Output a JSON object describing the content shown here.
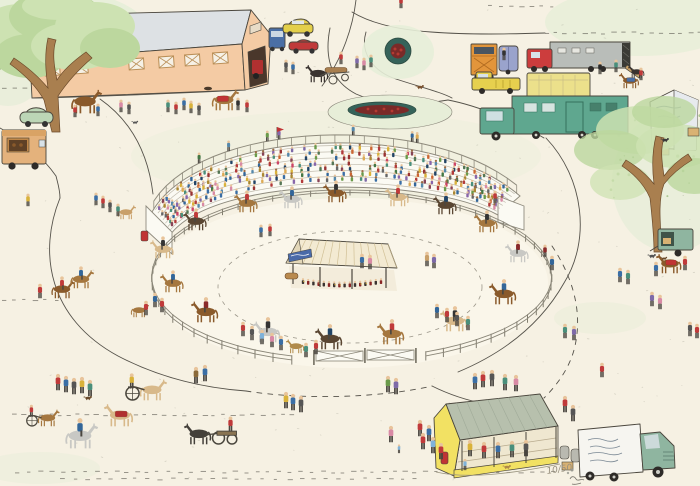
{
  "artwork": {
    "type": "hand-drawn pen and watercolor illustration",
    "subject": "aerial view of a country horse show with oval show ring, grandstand crowd, bandstand, horse lorries, stables and carriages",
    "edition_number": "10/50",
    "signature": "illegible artist signature in pencil",
    "lettering": {
      "prize_tent": "illegible faint hand lettering",
      "delivery_van": "illegible cursive hand lettering"
    }
  },
  "palette": {
    "paper": "#f6f1e3",
    "ringfloor": "#faf6ea",
    "wash": "#e7eed8",
    "ink": "#4a463d",
    "fence": "#85816f",
    "standwhite": "#fbfaf3",
    "barnwall": "#f4cba4",
    "barnroof": "#dde1e4",
    "trunk": "#a97f4f",
    "foliage": "#cde2b2",
    "foliage2": "#bcd79e",
    "caryellow": "#e3cf4a",
    "carblue": "#4a6fa5",
    "carred": "#c03a3a",
    "cargreen": "#bcd6b6",
    "boxtan": "#e4b27c",
    "truckorange": "#e2953b",
    "trailerlav": "#9aa3cc",
    "cabred": "#cc3d3d",
    "trailergray": "#b9bdb9",
    "pickupyellow": "#e6d04e",
    "boxcream": "#ece08b",
    "lorrygreen": "#5fa78f",
    "tentwhite": "#f3f3ef",
    "stallyellow": "#f2e163",
    "stallroof": "#b7c0ad",
    "vangreen": "#8fb5a0",
    "vanwhite": "#f6f5f0",
    "flowerred": "#b53a32",
    "bedgreen": "#35635a",
    "skin": "#e8c49b",
    "pants": "#4a4640"
  },
  "scene": {
    "speckles": 170,
    "dash_rows": [
      {
        "y": 472,
        "x1": 15,
        "x2": 555,
        "step": 9
      },
      {
        "y": 479,
        "x1": 60,
        "x2": 420,
        "step": 11
      },
      {
        "y": 415,
        "x1": 12,
        "x2": 296,
        "step": 8
      },
      {
        "y": 300,
        "x1": 2,
        "x2": 56,
        "step": 9
      },
      {
        "y": 88,
        "x1": 2,
        "x2": 28,
        "step": 8
      },
      {
        "y": 33,
        "x1": 545,
        "x2": 698,
        "step": 8
      },
      {
        "y": 6,
        "x1": 488,
        "x2": 560,
        "step": 9
      }
    ],
    "fence": {
      "cx": 350,
      "cy": 282,
      "rx": 200,
      "ry": 86,
      "posts": 64,
      "gate_deg": [
        72,
        104
      ]
    },
    "crowd": {
      "rows": 7,
      "seats_per_row": 48,
      "skip_rate": 0.18,
      "colors": [
        "#b23a3a",
        "#3a6ea5",
        "#4a8f7b",
        "#d9b23a",
        "#d98aa5",
        "#7e6aa8",
        "#6a9a4a",
        "#cc6633",
        "#447744",
        "#884455",
        "#5588aa",
        "#aa8833",
        "#336699",
        "#993333",
        "#557755",
        "#8866aa",
        "#ddaa55",
        "#cc4466",
        "#666666",
        "#224466"
      ],
      "skin": [
        "#e8c49b",
        "#9c6b44"
      ]
    },
    "people": [
      [
        28,
        206,
        "#d9b23a"
      ],
      [
        40,
        298,
        "#c03a3a"
      ],
      [
        96,
        205,
        "#3a6ea5"
      ],
      [
        103,
        208,
        "#c03a3a"
      ],
      [
        110,
        212,
        "#555555"
      ],
      [
        118,
        216,
        "#4a8f7b"
      ],
      [
        75,
        117,
        "#c03a3a"
      ],
      [
        98,
        116,
        "#3a6ea5"
      ],
      [
        121,
        112,
        "#d98aa5"
      ],
      [
        129,
        114,
        "#555555"
      ],
      [
        168,
        112,
        "#4a8f7b"
      ],
      [
        176,
        114,
        "#c03a3a"
      ],
      [
        184,
        110,
        "#3a6ea5"
      ],
      [
        191,
        113,
        "#d9b23a"
      ],
      [
        199,
        115,
        "#555555"
      ],
      [
        238,
        110,
        "#333333"
      ],
      [
        247,
        112,
        "#c03a3a"
      ],
      [
        286,
        72,
        "#555555"
      ],
      [
        293,
        74,
        "#3a6ea5"
      ],
      [
        341,
        64,
        "#c03a3a"
      ],
      [
        357,
        68,
        "#7e6aa8"
      ],
      [
        364,
        70,
        "#d98aa5"
      ],
      [
        371,
        67,
        "#4a8f7b"
      ],
      [
        401,
        8,
        "#c03a3a"
      ],
      [
        504,
        60,
        "#333333"
      ],
      [
        600,
        74,
        "#2a2a2a"
      ],
      [
        616,
        72,
        "#4a8f7b"
      ],
      [
        641,
        80,
        "#c03a3a"
      ],
      [
        620,
        282,
        "#3a6ea5"
      ],
      [
        628,
        284,
        "#4a8f7b"
      ],
      [
        652,
        306,
        "#7e6aa8"
      ],
      [
        660,
        309,
        "#d98aa5"
      ],
      [
        565,
        338,
        "#4a8f7b"
      ],
      [
        574,
        340,
        "#7e6aa8"
      ],
      [
        602,
        377,
        "#c03a3a"
      ],
      [
        690,
        336,
        "#555555"
      ],
      [
        697,
        338,
        "#c03a3a"
      ],
      [
        656,
        276,
        "#3a6ea5"
      ],
      [
        685,
        270,
        "#c03a3a"
      ],
      [
        475,
        389,
        "#3a6ea5"
      ],
      [
        483,
        387,
        "#c03a3a"
      ],
      [
        492,
        386,
        "#555555"
      ],
      [
        505,
        390,
        "#4a8f7b"
      ],
      [
        516,
        391,
        "#d98aa5"
      ],
      [
        565,
        412,
        "#c03a3a"
      ],
      [
        573,
        421,
        "#555555"
      ],
      [
        388,
        392,
        "#6a9a4a"
      ],
      [
        396,
        394,
        "#7e6aa8"
      ],
      [
        286,
        408,
        "#d9b23a"
      ],
      [
        293,
        410,
        "#3a6ea5"
      ],
      [
        301,
        412,
        "#555555"
      ],
      [
        391,
        442,
        "#d98aa5"
      ],
      [
        399,
        453,
        "#7fb2d9",
        0.7
      ],
      [
        420,
        436,
        "#c03a3a"
      ],
      [
        429,
        441,
        "#3a6ea5"
      ],
      [
        423,
        449,
        "#c03a3a"
      ],
      [
        433,
        453,
        "#7fb2d9"
      ],
      [
        441,
        459,
        "#c03a3a"
      ],
      [
        470,
        456,
        "#d9b23a"
      ],
      [
        484,
        458,
        "#c03a3a"
      ],
      [
        498,
        458,
        "#3a6ea5"
      ],
      [
        512,
        457,
        "#4a8f7b"
      ],
      [
        526,
        456,
        "#555555"
      ],
      [
        465,
        470,
        "#7fb2d9",
        0.9
      ],
      [
        58,
        390,
        "#c03a3a"
      ],
      [
        66,
        392,
        "#3a6ea5"
      ],
      [
        74,
        394,
        "#555555"
      ],
      [
        82,
        393,
        "#d9b23a"
      ],
      [
        90,
        396,
        "#4a8f7b"
      ],
      [
        196,
        383,
        "#8a6a3a"
      ],
      [
        205,
        381,
        "#3a6ea5"
      ],
      [
        146,
        315,
        "#c03a3a"
      ],
      [
        155,
        307,
        "#336699"
      ],
      [
        162,
        312,
        "#c03a3a"
      ],
      [
        243,
        336,
        "#c03a3a"
      ],
      [
        252,
        340,
        "#555555"
      ],
      [
        262,
        344,
        "#7fb2d9"
      ],
      [
        272,
        347,
        "#d98aa5"
      ],
      [
        281,
        350,
        "#3a6ea5"
      ],
      [
        306,
        357,
        "#4a8f7b"
      ],
      [
        316,
        354,
        "#c03a3a"
      ],
      [
        437,
        318,
        "#336699"
      ],
      [
        447,
        322,
        "#c03a3a"
      ],
      [
        457,
        326,
        "#555555"
      ],
      [
        468,
        330,
        "#4a8f7b"
      ],
      [
        545,
        257,
        "#8a2a2a"
      ],
      [
        552,
        270,
        "#336699"
      ],
      [
        495,
        203,
        "#c03a3a"
      ],
      [
        362,
        268,
        "#3a6ea5"
      ],
      [
        370,
        269,
        "#d98aa5"
      ],
      [
        427,
        266,
        "#c9a06a"
      ],
      [
        434,
        268,
        "#7e6aa8"
      ],
      [
        261,
        237,
        "#3a6ea5"
      ],
      [
        270,
        236,
        "#c03a3a"
      ]
    ],
    "riders": [
      [
        247,
        212,
        "#a5773f",
        "#c03a3a",
        0,
        1
      ],
      [
        292,
        208,
        "#c8c8c4",
        "#336699",
        0,
        1
      ],
      [
        336,
        202,
        "#8a5a2b",
        "#333333",
        0,
        1
      ],
      [
        398,
        206,
        "#d8b98a",
        "#c03a3a",
        0,
        1
      ],
      [
        446,
        214,
        "#5a4632",
        "#224466",
        0,
        1
      ],
      [
        487,
        232,
        "#a5773f",
        "#333333",
        0,
        1
      ],
      [
        518,
        262,
        "#c8c8c4",
        "#8a2a2a",
        0,
        1
      ],
      [
        504,
        304,
        "#8a5a2b",
        "#336699",
        0,
        1
      ],
      [
        455,
        331,
        "#d8b98a",
        "#333333",
        0,
        1
      ],
      [
        392,
        344,
        "#a5773f",
        "#c03a3a",
        0,
        1
      ],
      [
        330,
        349,
        "#5a4632",
        "#224466",
        0,
        1
      ],
      [
        268,
        342,
        "#c8c8c4",
        "#333333",
        0,
        1
      ],
      [
        206,
        322,
        "#8a5a2b",
        "#8a2a2a",
        0,
        1
      ],
      [
        173,
        292,
        "#a5773f",
        "#336699",
        0,
        1
      ],
      [
        163,
        258,
        "#d8b98a",
        "#333333",
        0,
        1
      ],
      [
        196,
        230,
        "#5a4632",
        "#c03a3a",
        0,
        1
      ],
      [
        62,
        298,
        "#8a5a2b",
        "#c03a3a",
        0,
        0
      ],
      [
        81,
        288,
        "#a5773f",
        "#336699",
        0,
        0
      ],
      [
        80,
        448,
        "#c8c8c4",
        "#336699",
        1.8,
        0
      ]
    ],
    "horses": [
      [
        85,
        113,
        "#8a5a2b",
        null,
        1.7,
        0
      ],
      [
        224,
        110,
        "#a5773f",
        "#c03434",
        1.5,
        0
      ],
      [
        126,
        219,
        "#c9a06a",
        null,
        1.0,
        0
      ],
      [
        637,
        78,
        "#3a3330",
        null,
        0.9,
        1
      ],
      [
        630,
        88,
        "#8a5a2b",
        "#4a6fa5",
        1.1,
        1
      ],
      [
        296,
        353,
        "#b08a4a",
        null,
        1.0,
        1
      ],
      [
        139,
        317,
        "#a5773f",
        null,
        1.0,
        0
      ],
      [
        670,
        273,
        "#8a5a2b",
        "#c03434",
        1.4,
        1
      ],
      [
        120,
        426,
        "#d8b98a",
        "#b03030",
        1.6,
        1
      ]
    ],
    "dogs": [
      [
        420,
        89,
        "#7a5230"
      ],
      [
        665,
        142,
        "#3a3a3a"
      ],
      [
        507,
        469,
        "#b08a4a"
      ],
      [
        652,
        258,
        "#555555"
      ],
      [
        664,
        260,
        "#6a4a2a",
        0.8
      ],
      [
        88,
        400,
        "#6a4a2a"
      ],
      [
        135,
        124,
        "#555555",
        0.8
      ]
    ],
    "carts": [
      [
        "sulky",
        140,
        400,
        "#d8b98a",
        "#d9b23a",
        1.5,
        0
      ],
      [
        "sulky",
        38,
        426,
        "#a5773f",
        "#c03a3a",
        1.2,
        0
      ],
      [
        "wagon",
        214,
        444,
        "#44403a",
        "#c03a3a",
        1.5,
        1
      ]
    ]
  }
}
